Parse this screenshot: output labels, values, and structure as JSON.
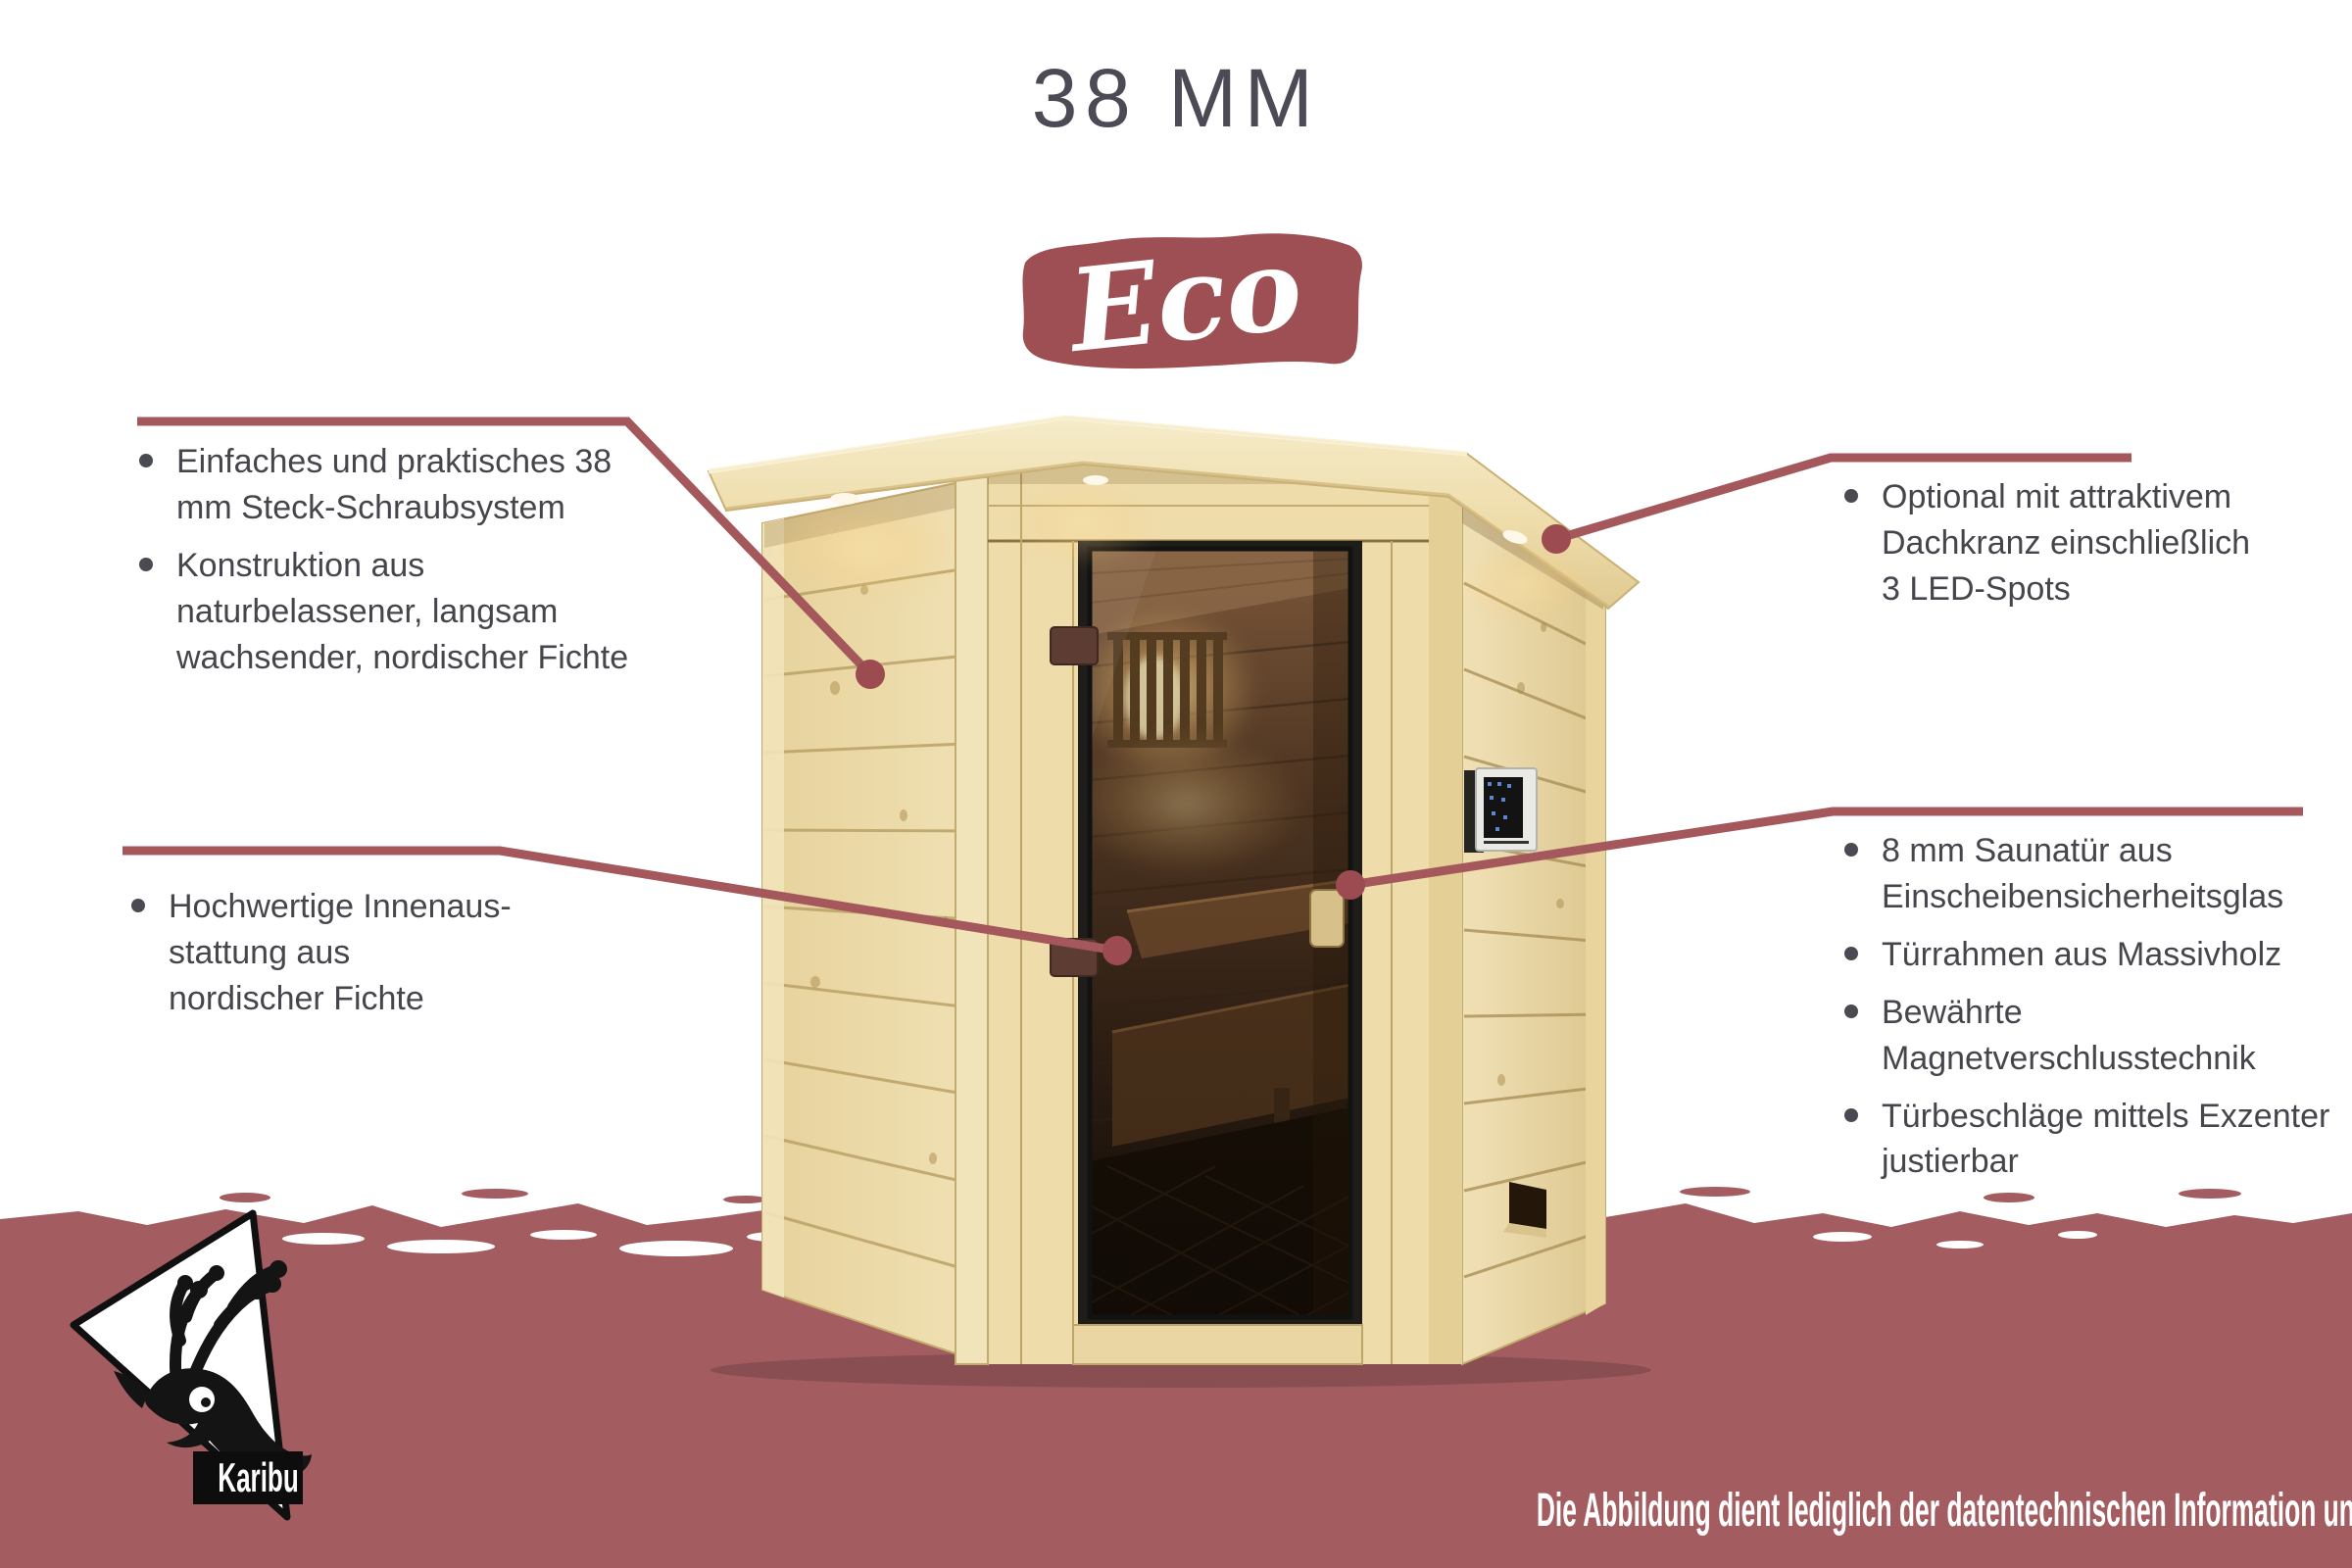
{
  "page": {
    "title": "38 MM",
    "badge": "Eco"
  },
  "callouts": {
    "left_top": {
      "items": [
        "Einfaches und praktisches 38 mm Steck-Schraubsystem",
        "Konstruktion aus naturbelassener, langsam wachsender, nordischer Fichte"
      ]
    },
    "left_bottom": {
      "items": [
        "Hochwertige Innenaus-stattung aus nordischer Fichte"
      ]
    },
    "right_top": {
      "items": [
        "Optional mit attraktivem Dachkranz einschließlich 3 LED-Spots"
      ]
    },
    "right_middle": {
      "items": [
        "8 mm Saunatür aus Einscheibensicherheitsglas",
        "Türrahmen aus Massivholz",
        "Bewährte Magnetverschlusstechnik",
        "Türbeschläge mittels Exzenter justierbar"
      ]
    }
  },
  "footer": {
    "disclaimer": "Die Abbildung dient lediglich der datentechnischen Information und bildet nicht den tatsächlichen Artikel ab."
  },
  "logo": {
    "brand": "Karibu"
  },
  "colors": {
    "accent_red": "#9e4f53",
    "callout_red": "#a4585c",
    "band_red": "#a35d61",
    "text_dark": "#45454c",
    "title_dark": "#4b4a55"
  }
}
